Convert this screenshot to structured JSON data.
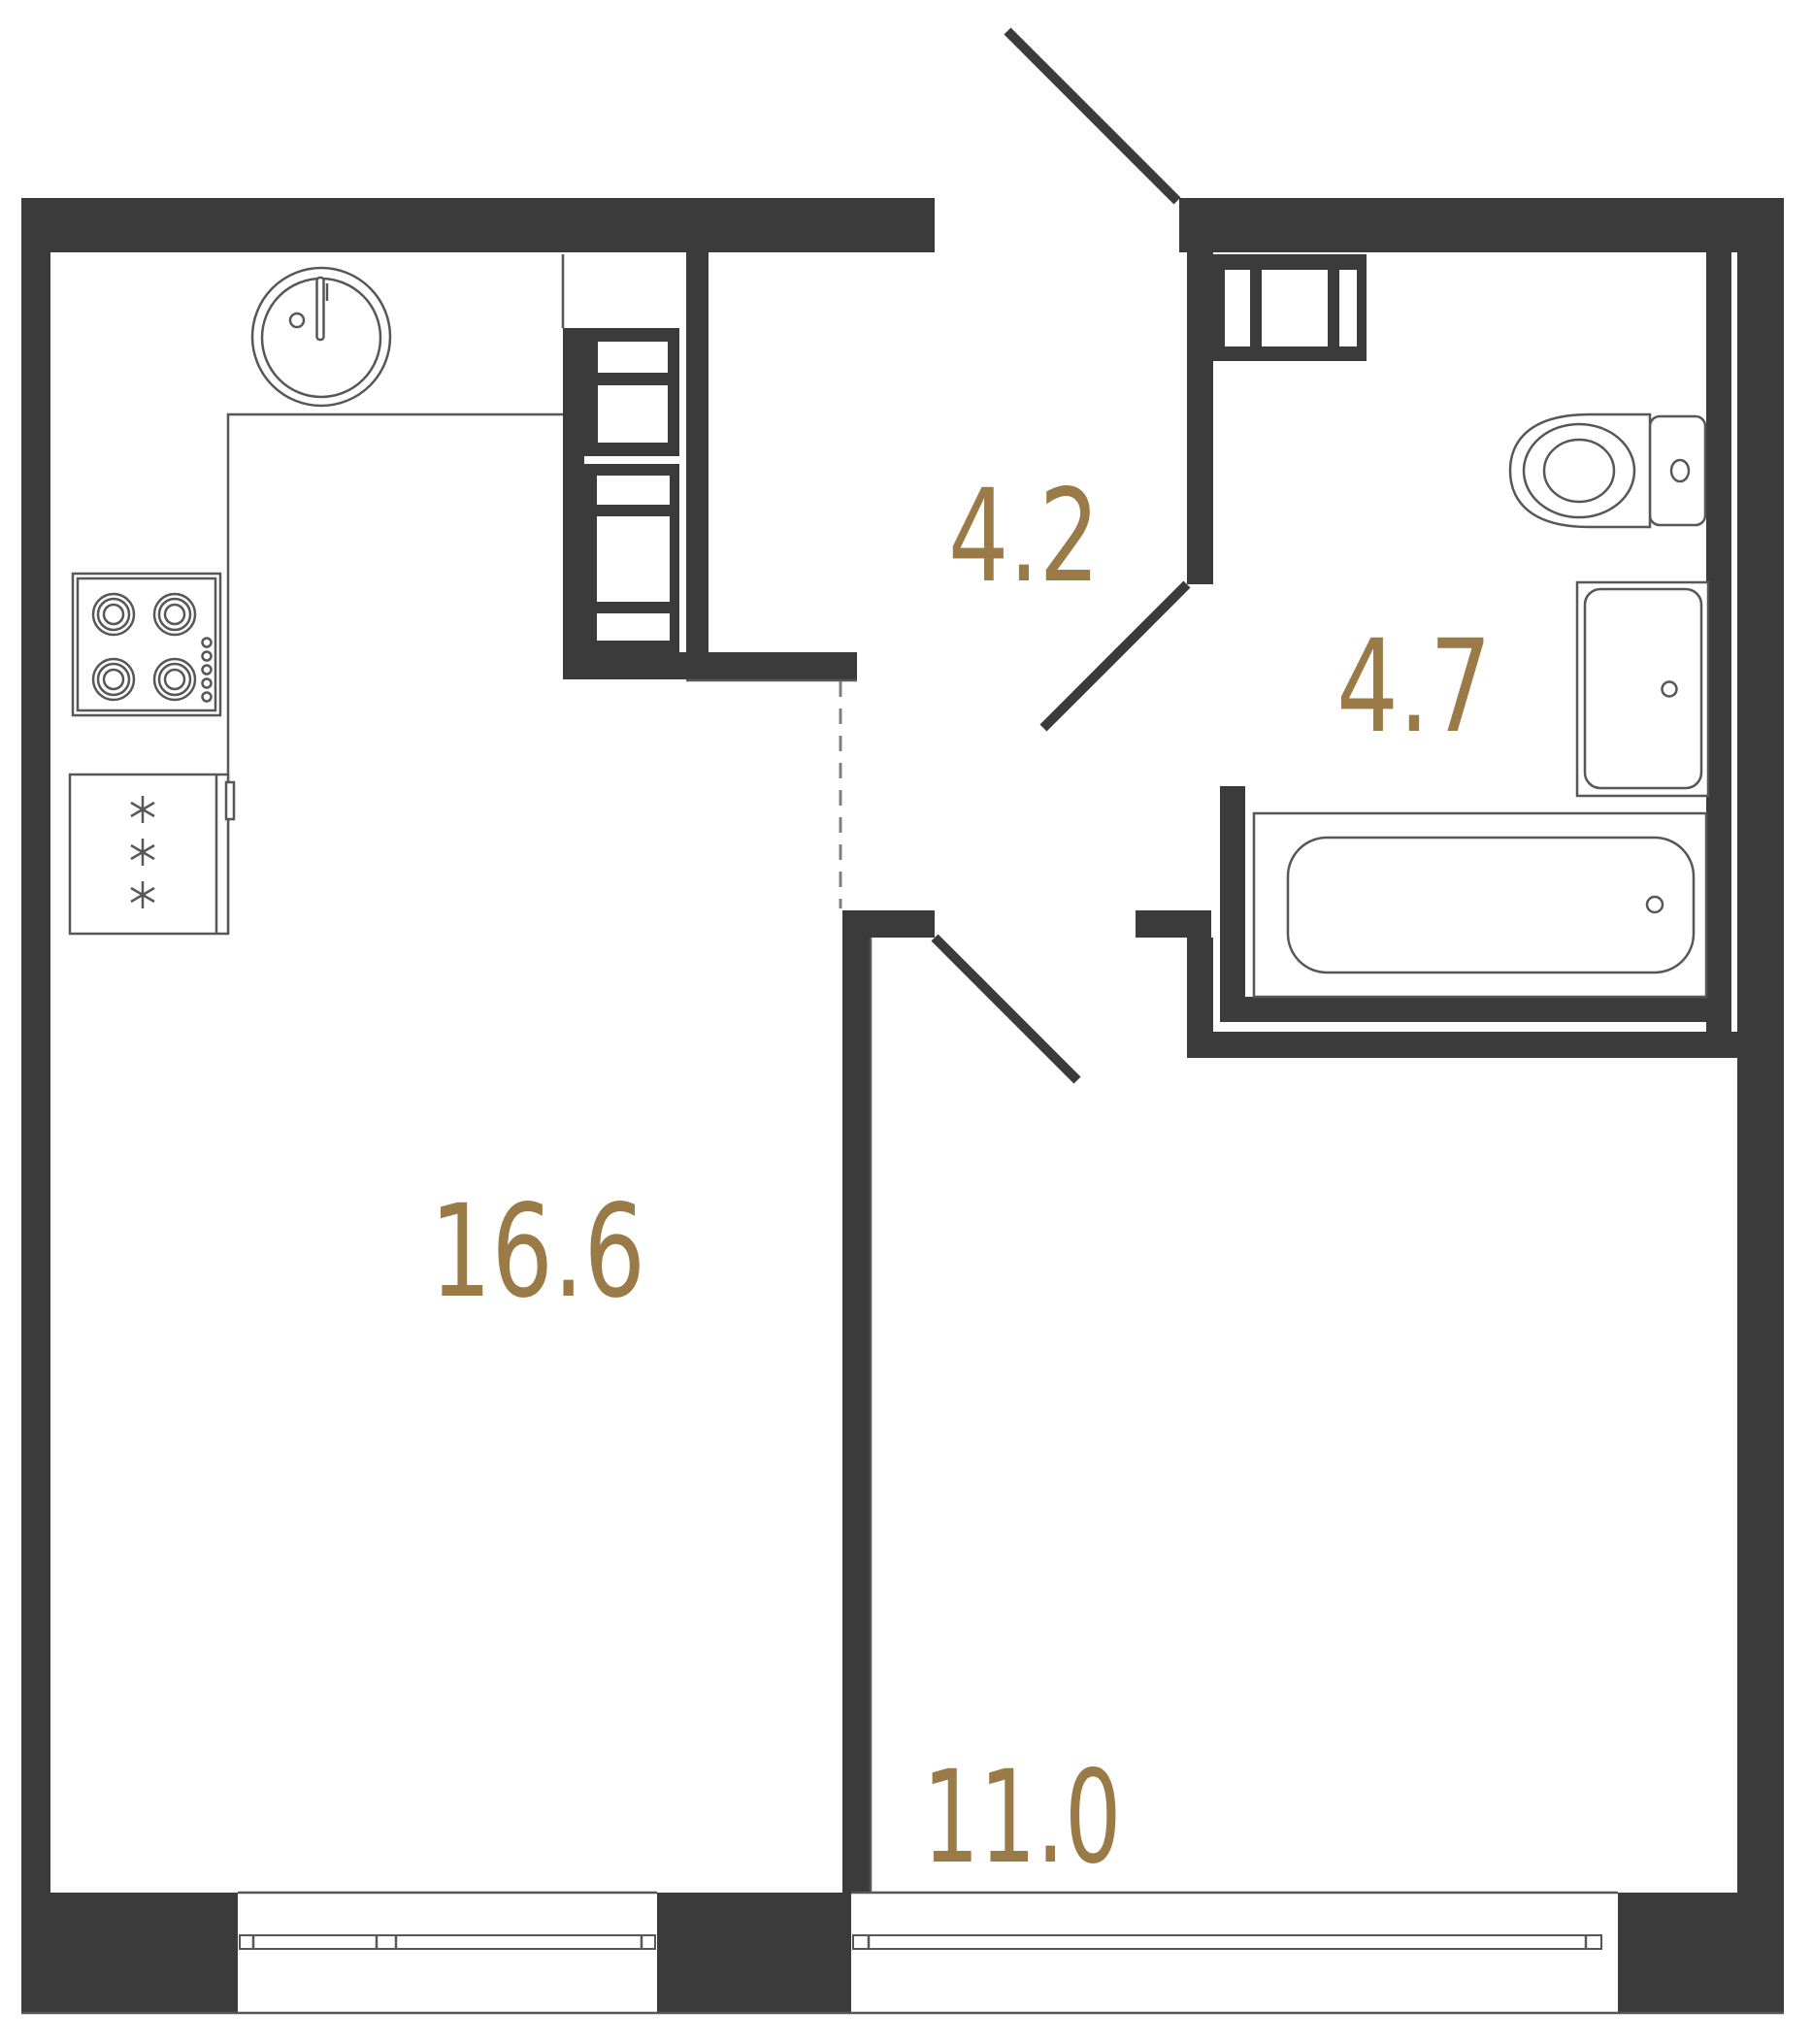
{
  "plan": {
    "type": "apartment-floor-plan",
    "rooms": [
      {
        "name": "living-room-kitchen",
        "area": "16.6"
      },
      {
        "name": "hallway",
        "area": "4.2"
      },
      {
        "name": "bathroom",
        "area": "4.7"
      },
      {
        "name": "bedroom",
        "area": "11.0"
      }
    ],
    "fixtures": [
      "kitchen-sink",
      "cooktop",
      "refrigerator",
      "built-in-wardrobe",
      "storage-cabinet",
      "toilet",
      "washbasin",
      "bathtub"
    ],
    "doors": [
      "entry-door",
      "bathroom-door",
      "bedroom-door"
    ],
    "windows": [
      "living-room-window",
      "bedroom-window"
    ]
  },
  "theme": {
    "wall_color": "#3b3b3b",
    "line_color": "#575757",
    "accent_color": "#9a7a46",
    "dash_color": "#808080",
    "background": "#ffffff"
  }
}
